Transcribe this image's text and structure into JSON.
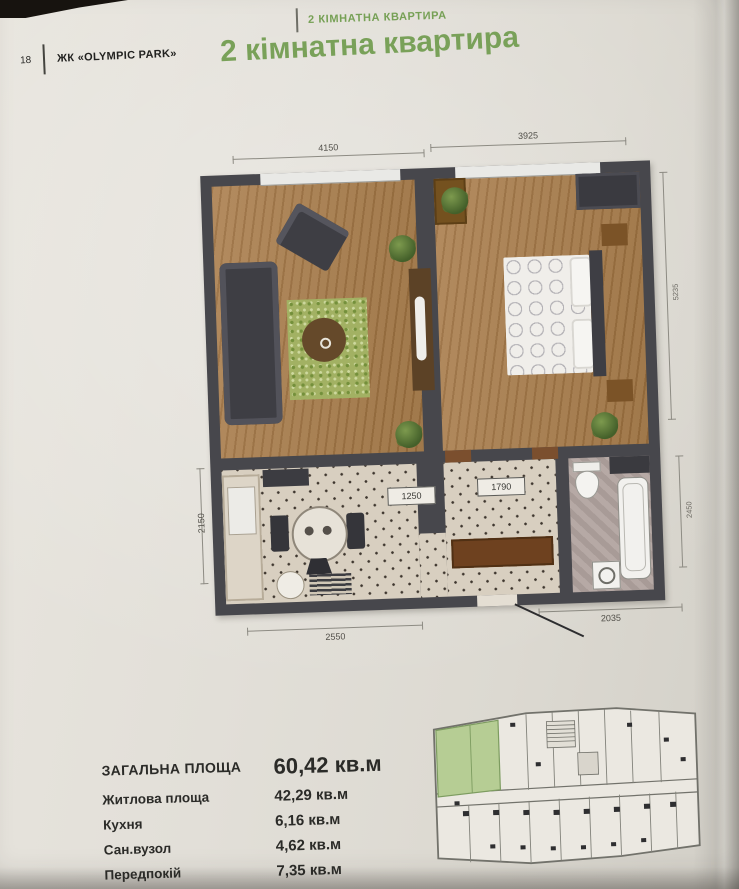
{
  "page": {
    "number": "18",
    "brand": "ЖК «OLYMPIC PARK»",
    "running_header": "2 КІМНАТНА КВАРТИРА",
    "title": "2 кімнатна квартира"
  },
  "colors": {
    "accent_green": "#79a159",
    "highlight_unit_green": "#b6cd94",
    "wall": "#47474c",
    "wood_floor": "#a5804f",
    "page_background": "#e2dfd8"
  },
  "floor_plan": {
    "dimensions": {
      "top_living": "4150",
      "top_bedroom": "3925",
      "side_left": "2150",
      "side_right_top": "5235",
      "side_right_bottom": "2450",
      "hall_left": "1250",
      "hall_right": "1790",
      "bottom_kitchen": "2550",
      "bottom_bathroom": "2035"
    }
  },
  "area_table": {
    "rows": [
      {
        "label": "ЗАГАЛЬНА ПЛОЩА",
        "value": "60,42 кв.м"
      },
      {
        "label": "Житлова площа",
        "value": "42,29 кв.м"
      },
      {
        "label": "Кухня",
        "value": "6,16 кв.м"
      },
      {
        "label": "Сан.вузол",
        "value": "4,62 кв.м"
      },
      {
        "label": "Передпокій",
        "value": "7,35 кв.м"
      }
    ]
  }
}
